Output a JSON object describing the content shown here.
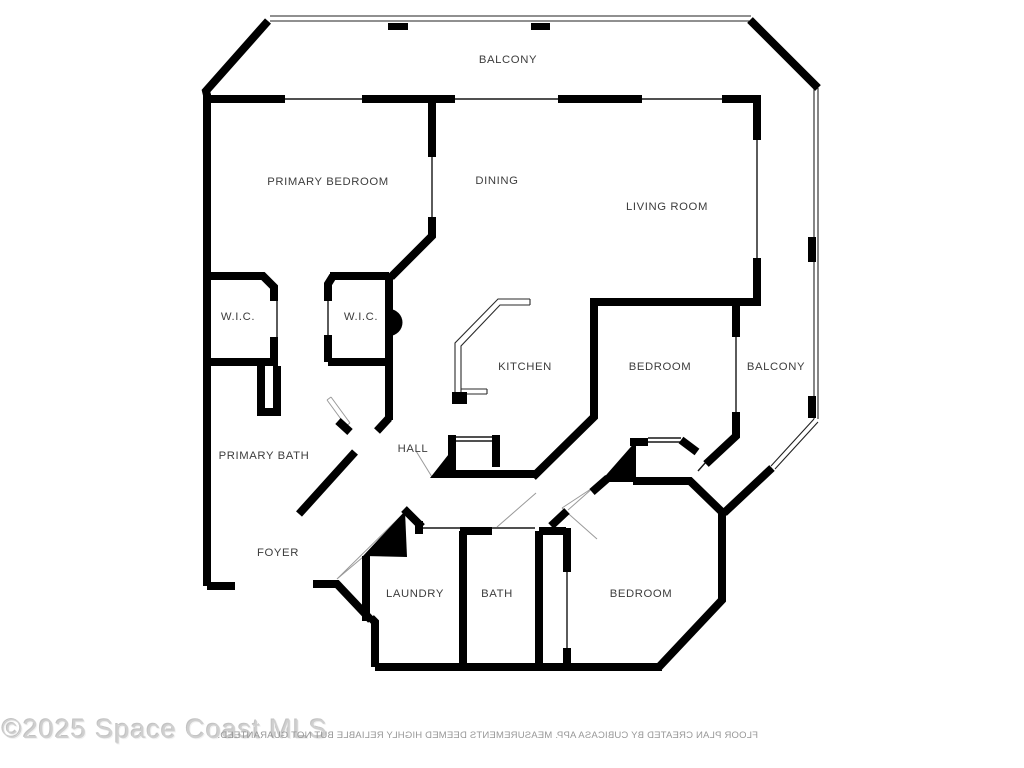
{
  "title": "Condominium floor plan",
  "watermark": "©2025 Space Coast MLS",
  "disclaimer": "FLOOR PLAN CREATED BY CUBICASA APP. MEASUREMENTS DEEMED HIGHLY RELIABLE BUT NOT GUARANTEED.",
  "colors": {
    "background": "#ffffff",
    "walls": "#000000",
    "labels": "#3d3d3d",
    "railing": "#222222",
    "door_arc": "#9a9a9a",
    "watermark": "#cfcfcf",
    "disclaimer": "#979797"
  },
  "rooms": [
    {
      "id": "balcony-top",
      "label": "BALCONY"
    },
    {
      "id": "primary-bedroom",
      "label": "PRIMARY BEDROOM"
    },
    {
      "id": "dining",
      "label": "DINING"
    },
    {
      "id": "living-room",
      "label": "LIVING ROOM"
    },
    {
      "id": "wic-1",
      "label": "W.I.C."
    },
    {
      "id": "wic-2",
      "label": "W.I.C."
    },
    {
      "id": "kitchen",
      "label": "KITCHEN"
    },
    {
      "id": "bedroom-middle",
      "label": "BEDROOM"
    },
    {
      "id": "balcony-side",
      "label": "BALCONY"
    },
    {
      "id": "primary-bath",
      "label": "PRIMARY BATH"
    },
    {
      "id": "hall",
      "label": "HALL"
    },
    {
      "id": "foyer",
      "label": "FOYER"
    },
    {
      "id": "laundry",
      "label": "LAUNDRY"
    },
    {
      "id": "bath",
      "label": "BATH"
    },
    {
      "id": "bedroom-bottom",
      "label": "BEDROOM"
    }
  ]
}
